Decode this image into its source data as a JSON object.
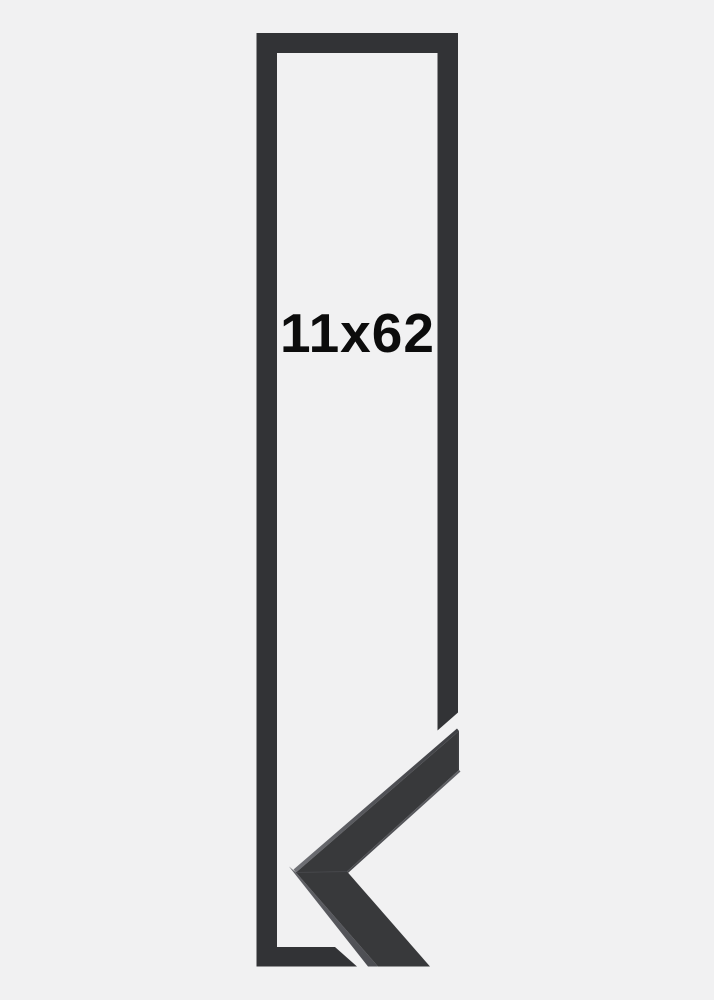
{
  "image": {
    "type": "picture-frame-size-preview",
    "size_label": "11x62"
  },
  "colors": {
    "background": "#f1f1f2",
    "frame_outline": "#323336",
    "moulding_face": "#38393b",
    "moulding_top_highlight": "#707176",
    "moulding_side_face": "#56575c",
    "moulding_inner_edge": "#606166",
    "label_text": "#0c0c0c"
  }
}
